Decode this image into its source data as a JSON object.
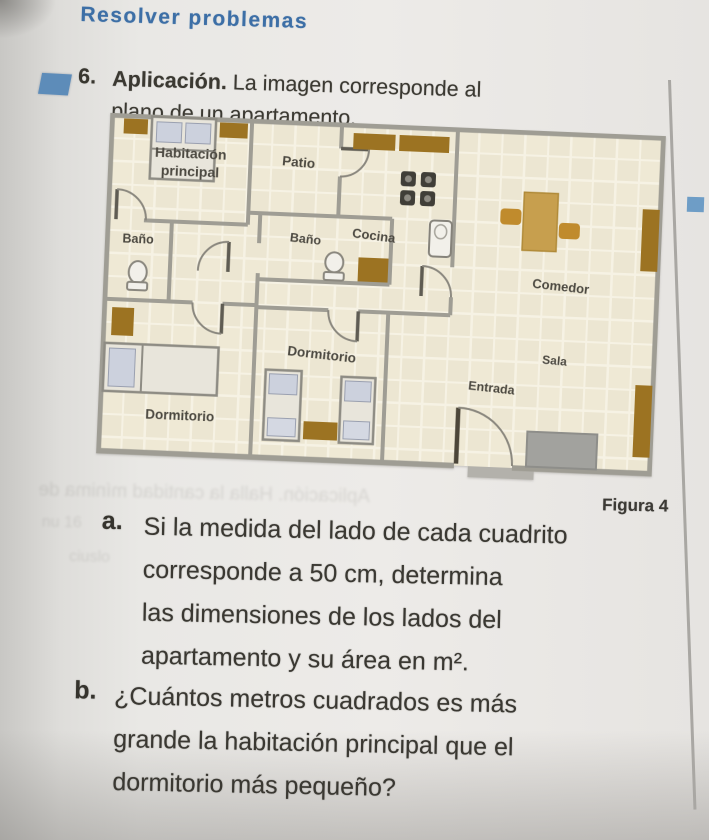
{
  "header": {
    "title": "Resolver problemas"
  },
  "problem": {
    "number": "6.",
    "lead": "Aplicación.",
    "statement_line1": "La imagen corresponde al",
    "statement_line2": "plano de un apartamento."
  },
  "figure": {
    "caption": "Figura 4",
    "grid_square_note": "floor plan drawn on square grid",
    "labels": {
      "main_room_1": "Habitación",
      "main_room_2": "principal",
      "patio": "Patio",
      "kitchen": "Cocina",
      "bath_left": "Baño",
      "bath_center": "Baño",
      "dining": "Comedor",
      "living": "Sala",
      "entrance": "Entrada",
      "bedroom_left": "Dormitorio",
      "bedroom_center": "Dormitorio"
    }
  },
  "questions": [
    {
      "letter": "a.",
      "lines": [
        "Si la medida del lado de cada cuadrito",
        "corresponde a 50 cm, determina",
        "las dimensiones de los lados del",
        "apartamento y su área en m²."
      ]
    },
    {
      "letter": "b.",
      "lines": [
        "¿Cuántos metros cuadrados es más",
        "grande la habitación principal que el",
        "dormitorio más pequeño?"
      ]
    }
  ],
  "ghost": {
    "caption_area": "Aplicación. Halla la cantidad mínima de",
    "margin_a": "nu 16",
    "margin_b": "ciuslo"
  },
  "colors": {
    "accent_blue": "#5d8cb9",
    "header_blue": "#3d6fa6",
    "plan_floor": "#ece6d2",
    "plan_grid_line": "#f6f2e4",
    "wall_gray": "#9f9d94",
    "furniture_brown": "#9c7322",
    "table_tan": "#c79f4e",
    "bed_pillow": "#ccd1dd",
    "sofa_gray": "#a2a29e"
  }
}
